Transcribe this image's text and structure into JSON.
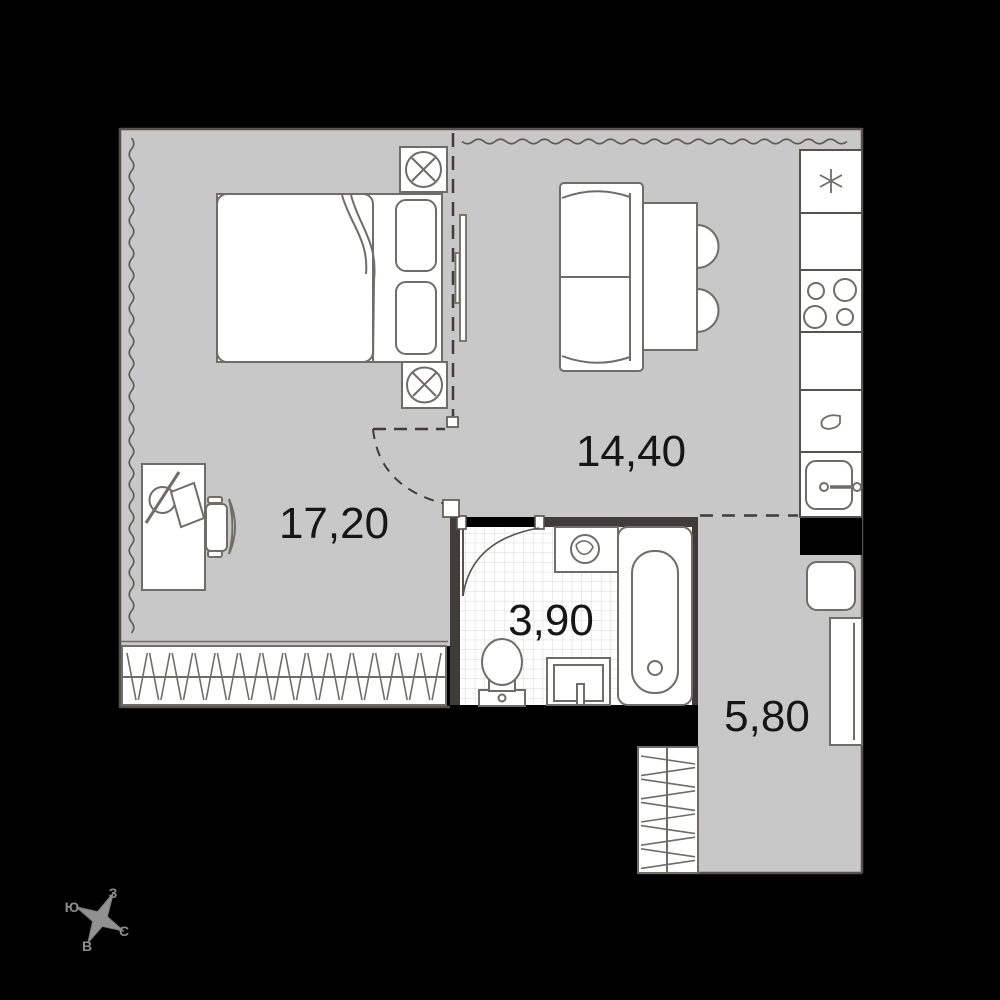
{
  "title": "studio-apartment-floor-plan",
  "rooms": [
    {
      "id": "bedroom-living",
      "area_label": "17,20"
    },
    {
      "id": "kitchen-living",
      "area_label": "14,40"
    },
    {
      "id": "bathroom",
      "area_label": "3,90"
    },
    {
      "id": "hallway",
      "area_label": "5,80"
    }
  ],
  "compass": {
    "top": "З",
    "left": "Ю",
    "right": "С",
    "bottom": "В"
  },
  "icons": {
    "fridge": "snowflake-asterisk-icon",
    "cooktop": "four-burner-circles-icon",
    "kitchen_sink": "basin-with-tap-icon",
    "bedside_lamp": "circle-with-cross-icon",
    "washing_machine": "drum-circle-icon",
    "desk_lamp": "circle-with-rod-icon"
  },
  "colors": {
    "background": "#000000",
    "floor": "#c8c8c8",
    "wall_dark": "#3e3d39",
    "outline": "#55534c",
    "furniture_stroke": "#6e6d66",
    "tile_line": "#d6d6d6",
    "label_text": "#161616",
    "compass_gray": "#8d8d8d"
  }
}
